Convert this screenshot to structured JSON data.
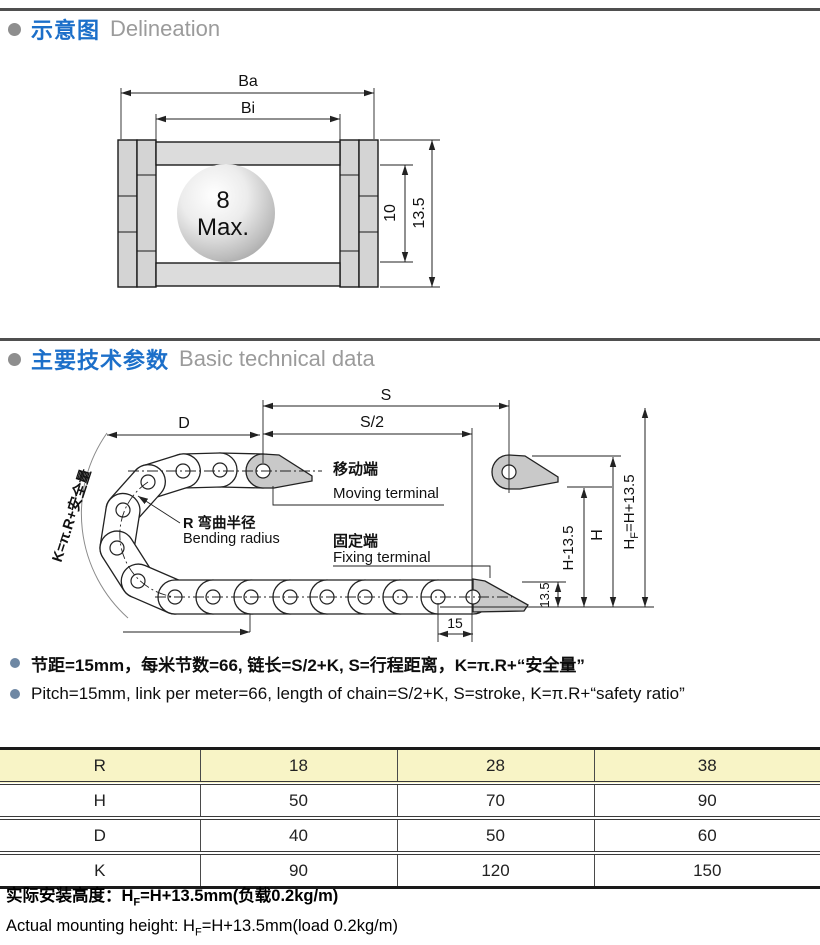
{
  "colors": {
    "accent_blue": "#1c6fc9",
    "header_gray": "#9b9b9b",
    "section_bullet": "#8e8e8e",
    "note_bullet": "#6e87a3",
    "table_header_bg": "#f8f4c6",
    "line_dark": "#222222",
    "rail_gray": "#d4d4d4",
    "bracket_gray": "#c9c9c9"
  },
  "sections": {
    "s1_zh": "示意图",
    "s1_en": "Delineation",
    "s2_zh": "主要技术参数",
    "s2_en": "Basic technical data"
  },
  "diagram1": {
    "ba": "Ba",
    "bi": "Bi",
    "ball_top": "8",
    "ball_bottom": "Max.",
    "inner_height": "10",
    "outer_height": "13.5"
  },
  "diagram2": {
    "d": "D",
    "s": "S",
    "s_half": "S/2",
    "k_formula": "K=π.R+安全量",
    "bend_zh": "R 弯曲半径",
    "bend_en": "Bending radius",
    "moving_zh": "移动端",
    "moving_en": "Moving terminal",
    "fixing_zh": "固定端",
    "fixing_en": "Fixing terminal",
    "h_minus": "H-13.5",
    "h": "H",
    "hf_pre": "H",
    "hf_sub": "F",
    "hf_post": "=H+13.5",
    "height_135": "13.5",
    "pitch_15": "15"
  },
  "notes": {
    "zh": "节距=15mm，每米节数=66, 链长=S/2+K, S=行程距离，K=π.R+“安全量”",
    "en": "Pitch=15mm, link per meter=66, length of chain=S/2+K, S=stroke, K=π.R+“safety ratio”"
  },
  "table": {
    "header": [
      "R",
      "18",
      "28",
      "38"
    ],
    "rows": [
      [
        "H",
        "50",
        "70",
        "90"
      ],
      [
        "D",
        "40",
        "50",
        "60"
      ],
      [
        "K",
        "90",
        "120",
        "150"
      ]
    ]
  },
  "footer": {
    "zh_pre": "实际安装高度：H",
    "zh_sub": "F",
    "zh_post": "=H+13.5mm(负载0.2kg/m)",
    "en_pre": "Actual mounting height: H",
    "en_sub": "F",
    "en_post": "=H+13.5mm(load 0.2kg/m)"
  }
}
